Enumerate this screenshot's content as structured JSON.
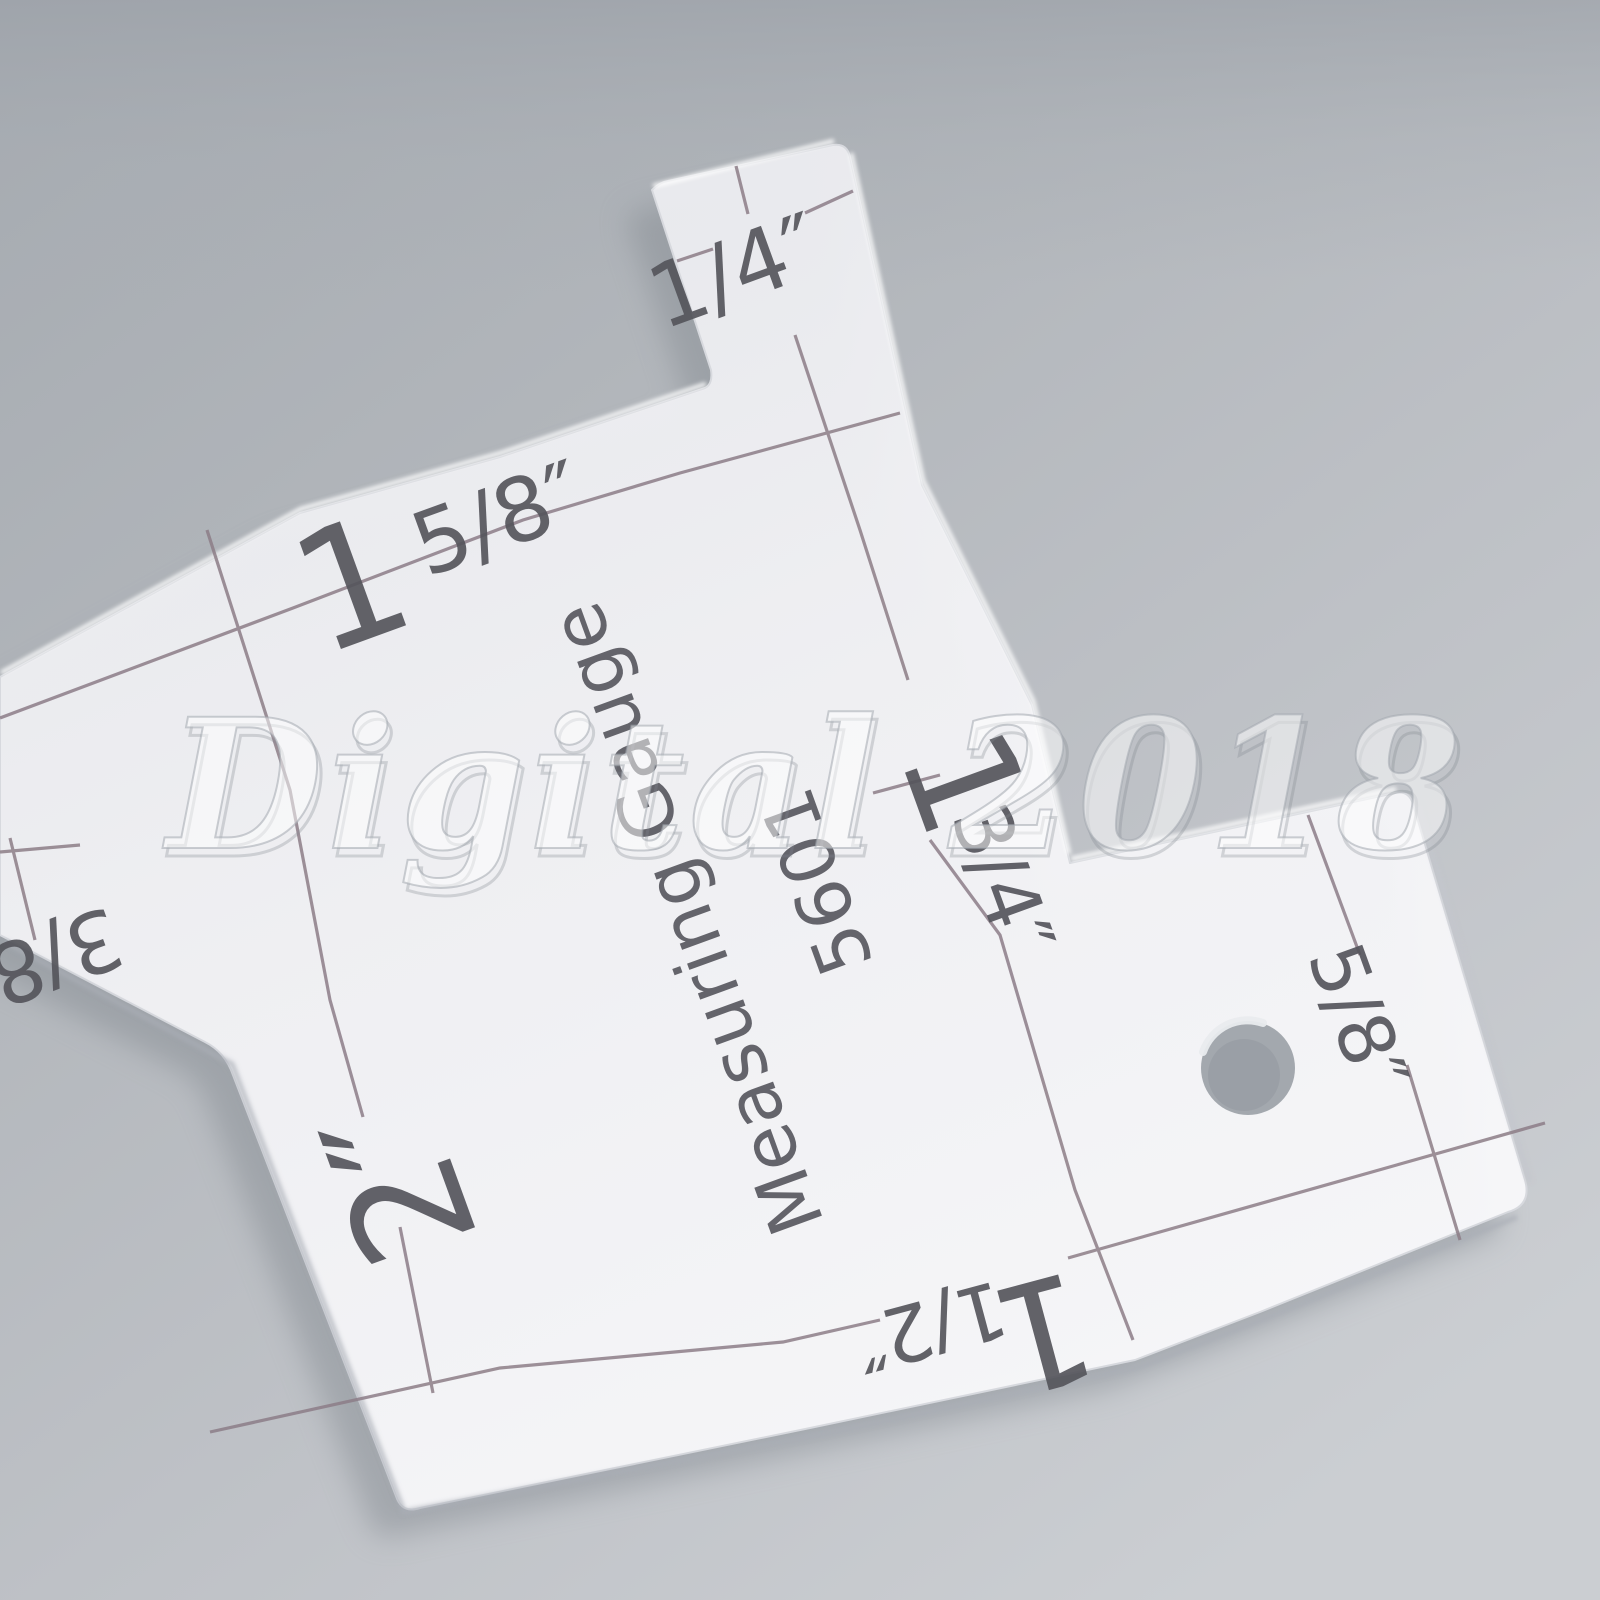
{
  "scene": {
    "description": "Transparent acrylic sewing measuring gauge photographed on a gray background",
    "background_top_color": "#a5aab0",
    "background_bottom_color": "#cbced2",
    "shadow_color": "#868c93"
  },
  "watermark": {
    "text": "Digital 2018",
    "color": "#ffffff"
  },
  "gauge": {
    "body_color": "#f3f3f6",
    "print_color": "#8c7d87",
    "text_color": "#55555c",
    "title": "Measuring Gauge",
    "model": "5601",
    "labels": {
      "quarter": {
        "text": "1/4″"
      },
      "one_five_eighth": {
        "whole": "1",
        "fraction": "5/8″"
      },
      "three_eighth": {
        "text": "3/8"
      },
      "two": {
        "text": "2″"
      },
      "one_three_quarter": {
        "whole": "1",
        "fraction": "3/4″"
      },
      "five_eighth": {
        "text": "5/8″"
      },
      "one_half": {
        "whole": "1",
        "fraction": "1/2″"
      }
    }
  }
}
